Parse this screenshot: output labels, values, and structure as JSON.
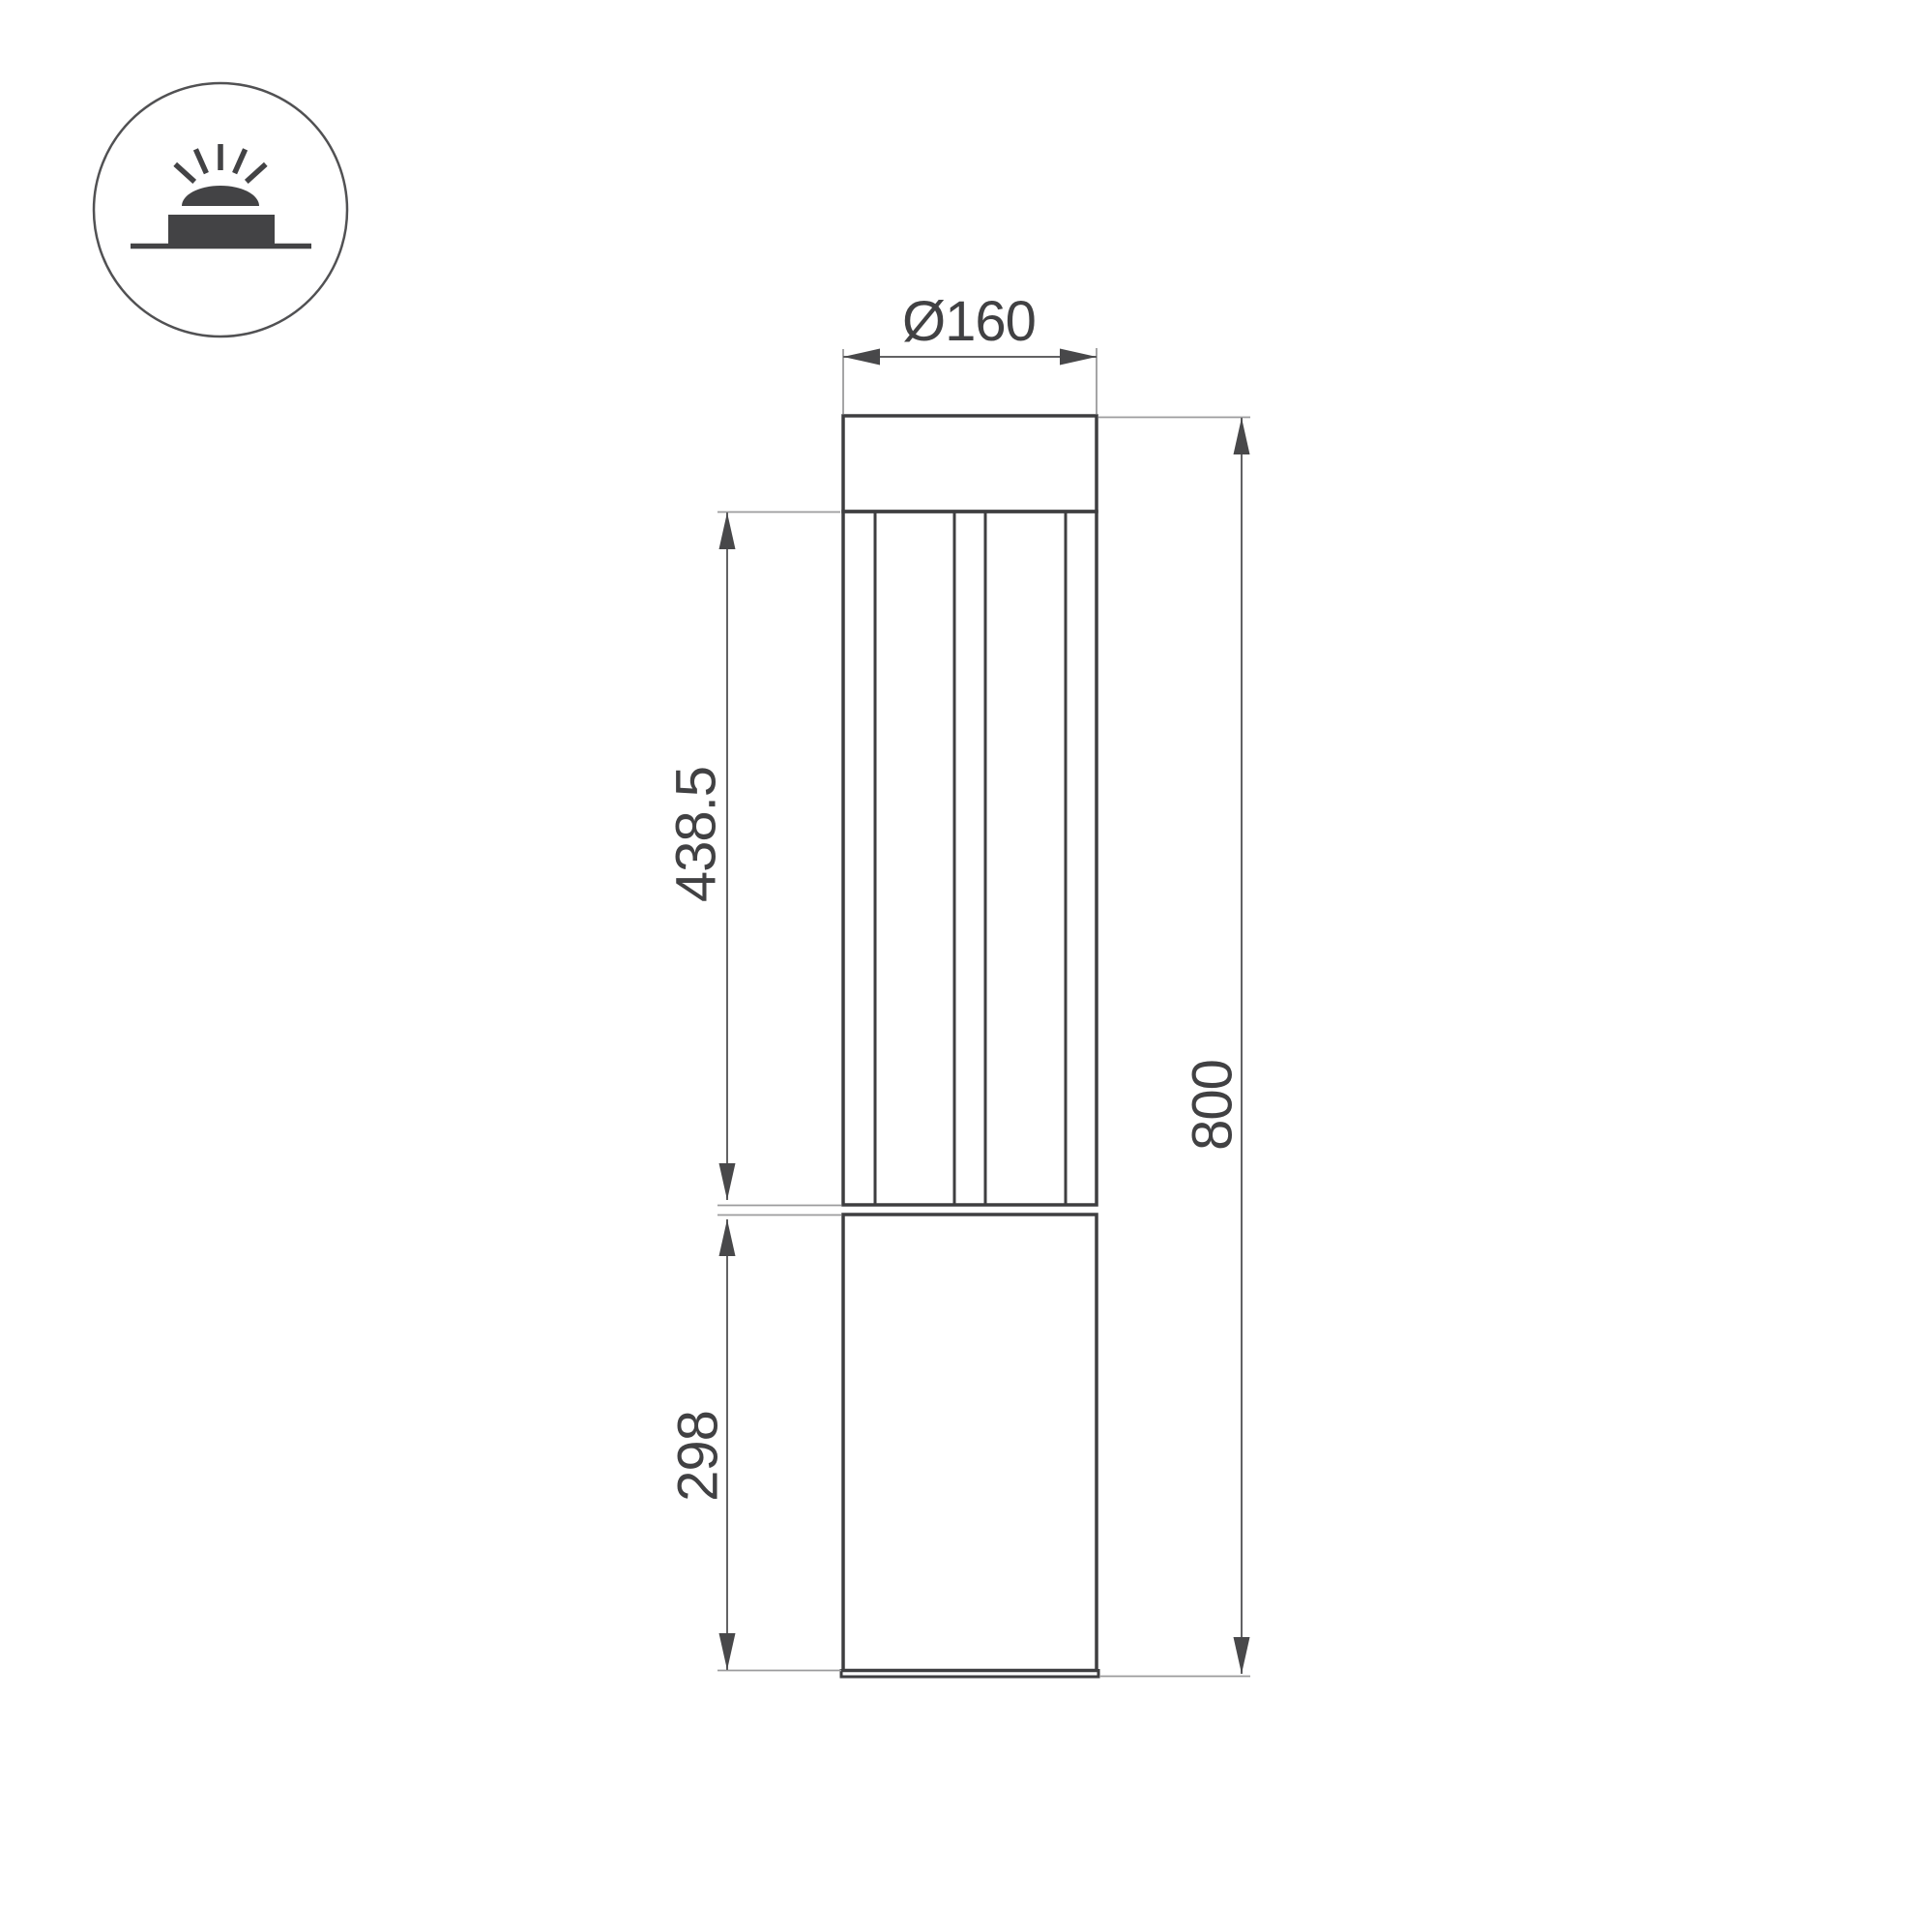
{
  "page": {
    "background": "#ffffff",
    "kind": "technical-dimension-drawing",
    "subject": "bollard luminaire front elevation"
  },
  "icon": {
    "name": "surface-mounted-uplight-icon",
    "meaning": "luminaire on a surface emitting light upward",
    "ray_count": 5
  },
  "dimensions": {
    "diameter": {
      "label": "Ø160",
      "value": 160,
      "orientation": "horizontal"
    },
    "light_section_height": {
      "label": "438.5",
      "value": 438.5,
      "orientation": "vertical"
    },
    "base_height": {
      "label": "298",
      "value": 298,
      "orientation": "vertical"
    },
    "total_height": {
      "label": "800",
      "value": 800,
      "orientation": "vertical"
    }
  },
  "colors": {
    "outline": "#3e3e40",
    "dimension_line": "#626264",
    "extension_line": "#9b9b9d",
    "arrow": "#48484a",
    "text": "#414143",
    "icon": "#434345",
    "background": "#ffffff"
  }
}
